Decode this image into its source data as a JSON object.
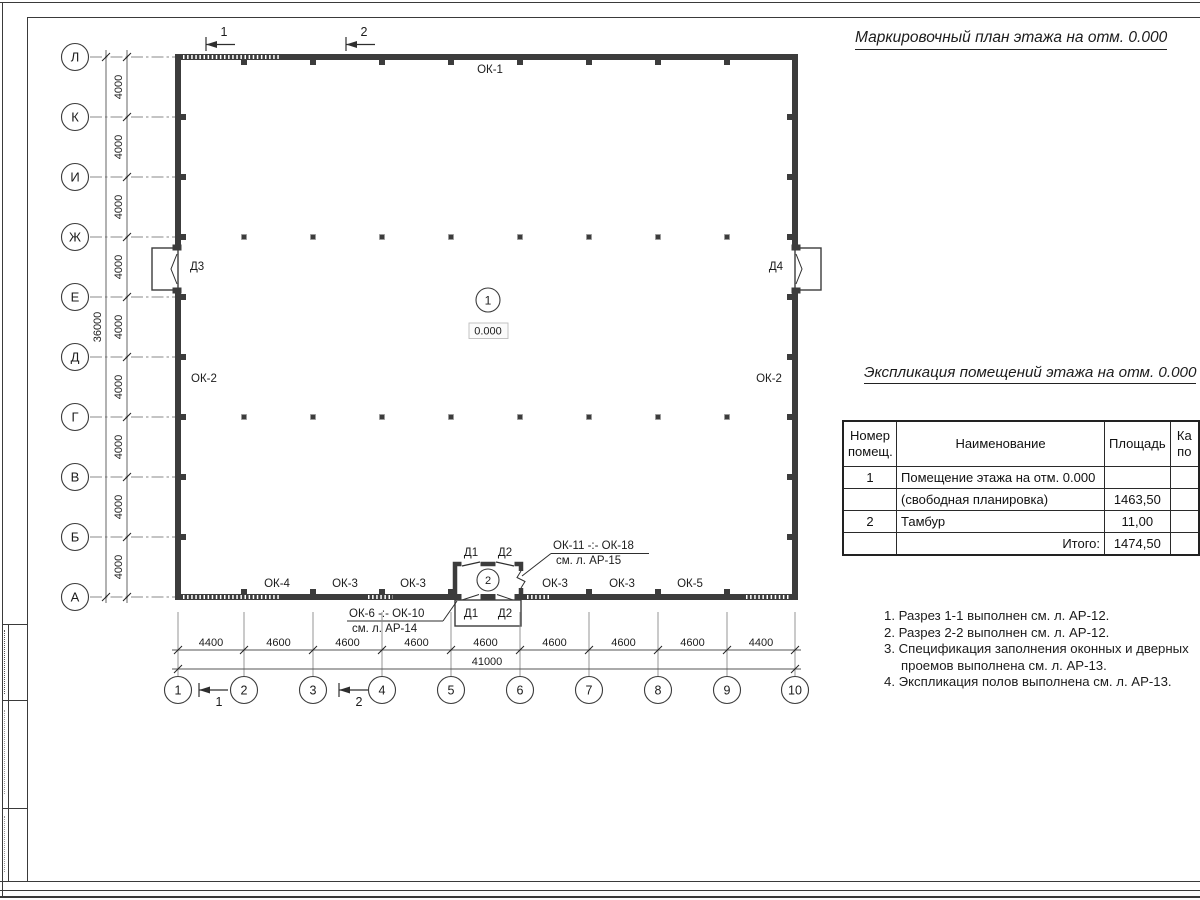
{
  "titles": {
    "main": "Маркировочный план этажа на отм. 0.000",
    "table": "Экспликация помещений этажа на отм. 0.000"
  },
  "table": {
    "headers": {
      "num": "Номер помещ.",
      "name": "Наименование",
      "area": "Площадь",
      "cut_line1": "Ка",
      "cut_line2": "по"
    },
    "rows": [
      {
        "num": "1",
        "name": "Помещение этажа на отм. 0.000",
        "area": ""
      },
      {
        "num": "",
        "name": "(свободная планировка)",
        "area": "1463,50"
      },
      {
        "num": "2",
        "name": "Тамбур",
        "area": "11,00"
      },
      {
        "num": "",
        "name": "Итого:",
        "area": "1474,50"
      }
    ]
  },
  "notes": [
    "1. Разрез 1-1 выполнен см. л. АР-12.",
    "2. Разрез 2-2 выполнен см. л. АР-12.",
    "3. Спецификация заполнения оконных и дверных проемов выполнена см. л. АР-13.",
    "4. Экспликация полов выполнена см. л. АР-13."
  ],
  "plan": {
    "row_axes": [
      "Л",
      "К",
      "И",
      "Ж",
      "Е",
      "Д",
      "Г",
      "В",
      "Б",
      "А"
    ],
    "col_axes": [
      "1",
      "2",
      "3",
      "4",
      "5",
      "6",
      "7",
      "8",
      "9",
      "10"
    ],
    "v_dims": [
      "4000",
      "4000",
      "4000",
      "4000",
      "4000",
      "4000",
      "4000",
      "4000",
      "4000"
    ],
    "v_total": "36000",
    "h_dims": [
      "4400",
      "4600",
      "4600",
      "4600",
      "4600",
      "4600",
      "4600",
      "4600",
      "4400"
    ],
    "h_total": "41000",
    "windows": {
      "top": "ОК-1",
      "left": "ОК-2",
      "right": "ОК-2",
      "bottom": [
        "ОК-4",
        "ОК-3",
        "ОК-3",
        "ОК-3",
        "ОК-3",
        "ОК-5"
      ]
    },
    "doors": {
      "d1": "Д1",
      "d2": "Д2",
      "d3": "Д3",
      "d4": "Д4"
    },
    "rooms": {
      "r1": "1",
      "r1_level": "0.000",
      "r2": "2"
    },
    "callouts": {
      "top1": "ОК-11 -:- ОК-18",
      "top2": "см. л. АР-15",
      "bottom1": "ОК-6 -:- ОК-10",
      "bottom2": "см. л. АР-14"
    },
    "sections": {
      "top1": "1",
      "top2": "2",
      "bottom1": "1",
      "bottom2": "2"
    }
  },
  "colors": {
    "wall": "#3c3c3c",
    "axis": "#8a8a8a",
    "text": "#1c1c1c"
  }
}
